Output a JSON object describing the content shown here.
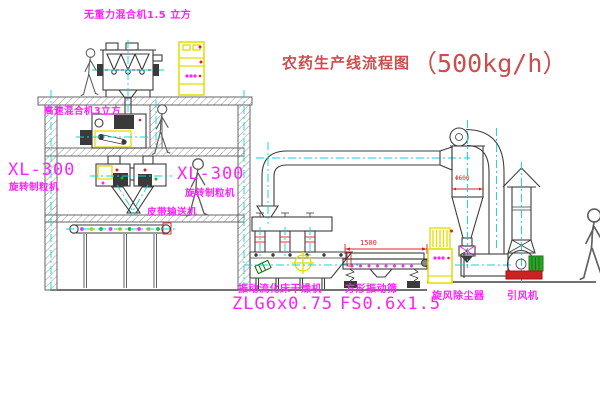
{
  "title": {
    "text": "农药生产线流程图",
    "capacity": "（500kg/h）"
  },
  "equipment_labels": {
    "gravity_free_mixer": "无重力混合机1.5 立方",
    "high_speed_mixer": "高速混合机3立方",
    "granulator_left_model": "XL-300",
    "granulator_left_name": "旋转制粒机",
    "granulator_mid_model": "XL-300",
    "granulator_mid_name": "旋转制粒机",
    "belt_conveyor": "皮带输送机",
    "fluid_bed_dryer_name": "振动流化床干燥机",
    "fluid_bed_dryer_model": "ZLG6x0.75",
    "square_sieve_name": "方形振动筛",
    "square_sieve_model": "FS0.6x1.5",
    "cyclone_name": "旋风除尘器",
    "induced_draft_fan_name": "引风机"
  },
  "dimensions": {
    "sieve_length": "1500",
    "cyclone_diameter": "Φ600"
  },
  "colors": {
    "label_magenta": "#ff22ff",
    "title_red": "#cc4d4d",
    "dim_red": "#e22020",
    "centerline_cyan": "#00d9d9",
    "cabinet_yellow": "#e3dc00",
    "line_gray": "#3d3d3d"
  }
}
